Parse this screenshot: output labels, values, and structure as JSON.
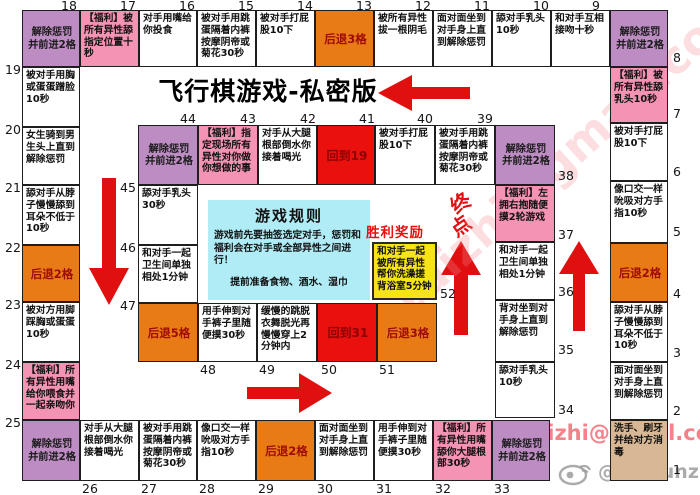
{
  "title": "飞行棋游戏-私密版",
  "rules": {
    "title": "游戏规则",
    "body": "游戏前先要抽签选定对手，惩罚和福利会在对手或全部异性之间进行！",
    "note": "提前准备食物、酒水、湿巾"
  },
  "finish": {
    "char1": "终",
    "char2": "点"
  },
  "victory_label": "胜利奖励",
  "watermarks": {
    "email": "91dizhi@gmail.com",
    "diagonal": "91dizhi@gmail.com",
    "weibo": "@leosunz"
  },
  "colors": {
    "relief_purple": "#bd8cc3",
    "reward_pink": "#f493b4",
    "back_orange": "#e97b17",
    "goto_red": "#ea100d",
    "start_tan": "#d7b794",
    "victory_yellow": "#f6e416",
    "rules_cyan": "#b0ecf6",
    "arrow_red": "#e01010"
  },
  "cells": [
    {
      "num": 1,
      "type": "start",
      "text": "洗手、刷牙并给对方消毒",
      "x": 610,
      "y": 420,
      "w": 58,
      "h": 61,
      "nx": 673,
      "ny": 464
    },
    {
      "num": 2,
      "type": "normal",
      "text": "面对面坐到对手身上直到解除惩罚",
      "x": 610,
      "y": 362,
      "w": 58,
      "h": 58,
      "nx": 673,
      "ny": 405
    },
    {
      "num": 3,
      "type": "normal",
      "text": "舔对手从脖子慢慢舔到耳朵不低于10秒",
      "x": 610,
      "y": 302,
      "w": 58,
      "h": 60,
      "nx": 673,
      "ny": 347
    },
    {
      "num": 4,
      "type": "back",
      "text": "后退2格",
      "x": 610,
      "y": 243,
      "w": 58,
      "h": 59,
      "nx": 673,
      "ny": 288
    },
    {
      "num": 5,
      "type": "normal",
      "text": "像口交一样吮吸对方手指10秒",
      "x": 610,
      "y": 181,
      "w": 58,
      "h": 62,
      "nx": 673,
      "ny": 226
    },
    {
      "num": 6,
      "type": "normal",
      "text": "被对手打屁股10下",
      "x": 610,
      "y": 123,
      "w": 58,
      "h": 58,
      "nx": 673,
      "ny": 166
    },
    {
      "num": 7,
      "type": "reward",
      "text": "【福利】被所有异性舔乳头10秒",
      "x": 610,
      "y": 67,
      "w": 58,
      "h": 56,
      "nx": 673,
      "ny": 108
    },
    {
      "num": 8,
      "type": "relief",
      "text": "解除惩罚\n并前进2格",
      "x": 610,
      "y": 10,
      "w": 58,
      "h": 57,
      "nx": 673,
      "ny": 52
    },
    {
      "num": 9,
      "type": "normal",
      "text": "和对手互相接吻十秒",
      "x": 551,
      "y": 10,
      "w": 59,
      "h": 57,
      "nx": 592,
      "ny": 0
    },
    {
      "num": 10,
      "type": "normal",
      "text": "舔对手乳头10秒",
      "x": 492,
      "y": 10,
      "w": 59,
      "h": 57,
      "nx": 533,
      "ny": 0
    },
    {
      "num": 11,
      "type": "normal",
      "text": "面对面坐到对手身上直到解除惩罚",
      "x": 433,
      "y": 10,
      "w": 59,
      "h": 57,
      "nx": 474,
      "ny": 0
    },
    {
      "num": 12,
      "type": "normal",
      "text": "被所有异性拔一根阴毛",
      "x": 374,
      "y": 10,
      "w": 59,
      "h": 57,
      "nx": 415,
      "ny": 0
    },
    {
      "num": 13,
      "type": "back",
      "text": "后退3格",
      "x": 315,
      "y": 10,
      "w": 59,
      "h": 57,
      "nx": 356,
      "ny": 0
    },
    {
      "num": 14,
      "type": "normal",
      "text": "被对手打屁股10下",
      "x": 256,
      "y": 10,
      "w": 59,
      "h": 57,
      "nx": 297,
      "ny": 0
    },
    {
      "num": 15,
      "type": "normal",
      "text": "被对手用跳蛋隔着内裤按摩阴帝或菊花30秒",
      "x": 197,
      "y": 10,
      "w": 59,
      "h": 57,
      "nx": 238,
      "ny": 0
    },
    {
      "num": 16,
      "type": "normal",
      "text": "对手用嘴给你投食",
      "x": 139,
      "y": 10,
      "w": 58,
      "h": 57,
      "nx": 179,
      "ny": 0
    },
    {
      "num": 17,
      "type": "reward",
      "text": "【福利】被所有异性舔指定位置十秒",
      "x": 80,
      "y": 10,
      "w": 59,
      "h": 57,
      "nx": 120,
      "ny": 0
    },
    {
      "num": 18,
      "type": "relief",
      "text": "解除惩罚\n并前进2格",
      "x": 22,
      "y": 10,
      "w": 58,
      "h": 57,
      "nx": 61,
      "ny": 0
    },
    {
      "num": 19,
      "type": "normal",
      "text": "被对手用胸或蛋蛋蹭脸10秒",
      "x": 22,
      "y": 67,
      "w": 58,
      "h": 60,
      "nx": 5,
      "ny": 64
    },
    {
      "num": 20,
      "type": "normal",
      "text": "女生骑到男生头上直到解除惩罚",
      "x": 22,
      "y": 127,
      "w": 58,
      "h": 58,
      "nx": 5,
      "ny": 124
    },
    {
      "num": 21,
      "type": "normal",
      "text": "舔对手从脖子慢慢舔到耳朵不低于10秒",
      "x": 22,
      "y": 185,
      "w": 58,
      "h": 60,
      "nx": 5,
      "ny": 182
    },
    {
      "num": 22,
      "type": "back",
      "text": "后退2格",
      "x": 22,
      "y": 245,
      "w": 58,
      "h": 57,
      "nx": 5,
      "ny": 242
    },
    {
      "num": 23,
      "type": "normal",
      "text": "被对方用脚踩胸或蛋蛋10秒",
      "x": 22,
      "y": 302,
      "w": 58,
      "h": 60,
      "nx": 5,
      "ny": 299
    },
    {
      "num": 24,
      "type": "reward",
      "text": "【福利】所有异性用嘴给你喂食并一起亲吻你",
      "x": 22,
      "y": 362,
      "w": 58,
      "h": 58,
      "nx": 5,
      "ny": 359
    },
    {
      "num": 25,
      "type": "relief",
      "text": "解除惩罚\n并前进2格",
      "x": 22,
      "y": 420,
      "w": 58,
      "h": 61,
      "nx": 5,
      "ny": 417
    },
    {
      "num": 26,
      "type": "normal",
      "text": "对手从大腿根部倒水你接着喝光",
      "x": 80,
      "y": 420,
      "w": 59,
      "h": 61,
      "nx": 82,
      "ny": 483
    },
    {
      "num": 27,
      "type": "normal",
      "text": "被对手用跳蛋隔着内裤按摩阴帝或菊花30秒",
      "x": 139,
      "y": 420,
      "w": 58,
      "h": 61,
      "nx": 141,
      "ny": 483
    },
    {
      "num": 28,
      "type": "normal",
      "text": "像口交一样吮吸对方手指10秒",
      "x": 197,
      "y": 420,
      "w": 59,
      "h": 61,
      "nx": 199,
      "ny": 483
    },
    {
      "num": 29,
      "type": "back",
      "text": "后退2格",
      "x": 256,
      "y": 420,
      "w": 59,
      "h": 61,
      "nx": 258,
      "ny": 483
    },
    {
      "num": 30,
      "type": "normal",
      "text": "面对面坐到对手身上直到解除惩罚",
      "x": 315,
      "y": 420,
      "w": 59,
      "h": 61,
      "nx": 317,
      "ny": 483
    },
    {
      "num": 31,
      "type": "normal",
      "text": "用手伸到对手裤子里随便摸30秒",
      "x": 374,
      "y": 420,
      "w": 59,
      "h": 61,
      "nx": 376,
      "ny": 483
    },
    {
      "num": 32,
      "type": "reward",
      "text": "【福利】所有异性用嘴舔你大腿根部30秒",
      "x": 433,
      "y": 420,
      "w": 59,
      "h": 61,
      "nx": 435,
      "ny": 483
    },
    {
      "num": 33,
      "type": "relief",
      "text": "解除惩罚\n并前进2格",
      "x": 492,
      "y": 420,
      "w": 58,
      "h": 61,
      "nx": 494,
      "ny": 483
    },
    {
      "num": 34,
      "type": "normal",
      "text": "舔对手乳头10秒",
      "x": 495,
      "y": 362,
      "w": 60,
      "h": 56,
      "nx": 558,
      "ny": 404
    },
    {
      "num": 35,
      "type": "normal",
      "text": "背对坐到对手身上直到解除惩罚",
      "x": 495,
      "y": 300,
      "w": 60,
      "h": 62,
      "nx": 558,
      "ny": 344
    },
    {
      "num": 36,
      "type": "normal",
      "text": "和对手一起卫生间单独相处1分钟",
      "x": 495,
      "y": 242,
      "w": 60,
      "h": 58,
      "nx": 558,
      "ny": 286
    },
    {
      "num": 37,
      "type": "reward",
      "text": "【福利】左拥右抱随便摸2轮游戏",
      "x": 495,
      "y": 185,
      "w": 60,
      "h": 57,
      "nx": 558,
      "ny": 229
    },
    {
      "num": 38,
      "type": "relief",
      "text": "解除惩罚\n并前进2格",
      "x": 495,
      "y": 125,
      "w": 60,
      "h": 60,
      "nx": 558,
      "ny": 170
    },
    {
      "num": 39,
      "type": "normal",
      "text": "被对手用跳蛋隔着内裤按摩阴帝或菊花30秒",
      "x": 435,
      "y": 125,
      "w": 60,
      "h": 60,
      "nx": 477,
      "ny": 113
    },
    {
      "num": 40,
      "type": "normal",
      "text": "被对手打屁股10下",
      "x": 375,
      "y": 125,
      "w": 60,
      "h": 60,
      "nx": 417,
      "ny": 113
    },
    {
      "num": 41,
      "type": "goto",
      "text": "回到19",
      "x": 317,
      "y": 125,
      "w": 58,
      "h": 60,
      "nx": 359,
      "ny": 113
    },
    {
      "num": 42,
      "type": "normal",
      "text": "对手从大腿根部倒水你接着喝光",
      "x": 258,
      "y": 125,
      "w": 59,
      "h": 60,
      "nx": 300,
      "ny": 113
    },
    {
      "num": 43,
      "type": "reward",
      "text": "【福利】指定现场所有异性对你做你想做的事",
      "x": 198,
      "y": 125,
      "w": 60,
      "h": 60,
      "nx": 240,
      "ny": 113
    },
    {
      "num": 44,
      "type": "relief",
      "text": "解除惩罚\n并前进2格",
      "x": 138,
      "y": 125,
      "w": 60,
      "h": 60,
      "nx": 180,
      "ny": 113
    },
    {
      "num": 45,
      "type": "normal",
      "text": "舔对手乳头30秒",
      "x": 138,
      "y": 185,
      "w": 60,
      "h": 60,
      "nx": 120,
      "ny": 182
    },
    {
      "num": 46,
      "type": "normal",
      "text": "和对手一起卫生间单独相处1分钟",
      "x": 138,
      "y": 245,
      "w": 60,
      "h": 58,
      "nx": 120,
      "ny": 242
    },
    {
      "num": 47,
      "type": "back",
      "text": "后退5格",
      "x": 138,
      "y": 303,
      "w": 60,
      "h": 59,
      "nx": 120,
      "ny": 300
    },
    {
      "num": 48,
      "type": "normal",
      "text": "用手伸到对手裤子里随便摸30秒",
      "x": 198,
      "y": 303,
      "w": 59,
      "h": 59,
      "nx": 200,
      "ny": 364
    },
    {
      "num": 49,
      "type": "normal",
      "text": "缓慢的跳脱衣舞脱光再慢慢穿上2分钟内",
      "x": 257,
      "y": 303,
      "w": 60,
      "h": 59,
      "nx": 259,
      "ny": 364
    },
    {
      "num": 50,
      "type": "goto",
      "text": "回到31",
      "x": 317,
      "y": 303,
      "w": 60,
      "h": 59,
      "nx": 321,
      "ny": 364
    },
    {
      "num": 51,
      "type": "back",
      "text": "后退3格",
      "x": 377,
      "y": 303,
      "w": 60,
      "h": 59,
      "nx": 379,
      "ny": 364
    },
    {
      "num": 52,
      "type": "victory",
      "text": "和对手一起被所有异性帮你洗澡搓背浴室5分钟",
      "x": 372,
      "y": 242,
      "w": 65,
      "h": 58,
      "nx": 440,
      "ny": 288
    }
  ]
}
